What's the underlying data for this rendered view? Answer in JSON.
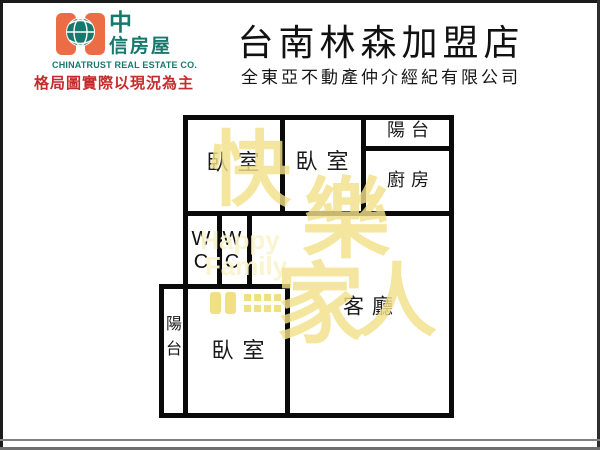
{
  "brand": {
    "logo_char_top": "中",
    "logo_chars_bottom": "信房屋",
    "company_en": "CHINATRUST REAL ESTATE CO.",
    "disclaimer": "格局圖實際以現況為主"
  },
  "header": {
    "store_name": "台南林森加盟店",
    "agency_name": "全東亞不動產仲介經紀有限公司"
  },
  "floorplan": {
    "labels": {
      "bedroom1": "臥室",
      "bedroom2": "臥室",
      "bedroom3": "臥室",
      "balcony_top": "陽台",
      "balcony_bottom": "陽台",
      "kitchen": "廚房",
      "living_room": "客廳",
      "wc_w": "W",
      "wc_c": "C"
    }
  },
  "watermark": {
    "chars": [
      "快",
      "樂",
      "家",
      "人"
    ],
    "latin": [
      "Happy",
      "Family"
    ]
  },
  "colors": {
    "brand_orange": "#EC6C45",
    "brand_teal": "#16796C",
    "disclaimer_red": "#C42B2B",
    "wall_black": "#0A0A0A",
    "watermark_yellow": "#F1E08A",
    "watermark_light": "#FAF3CD"
  }
}
